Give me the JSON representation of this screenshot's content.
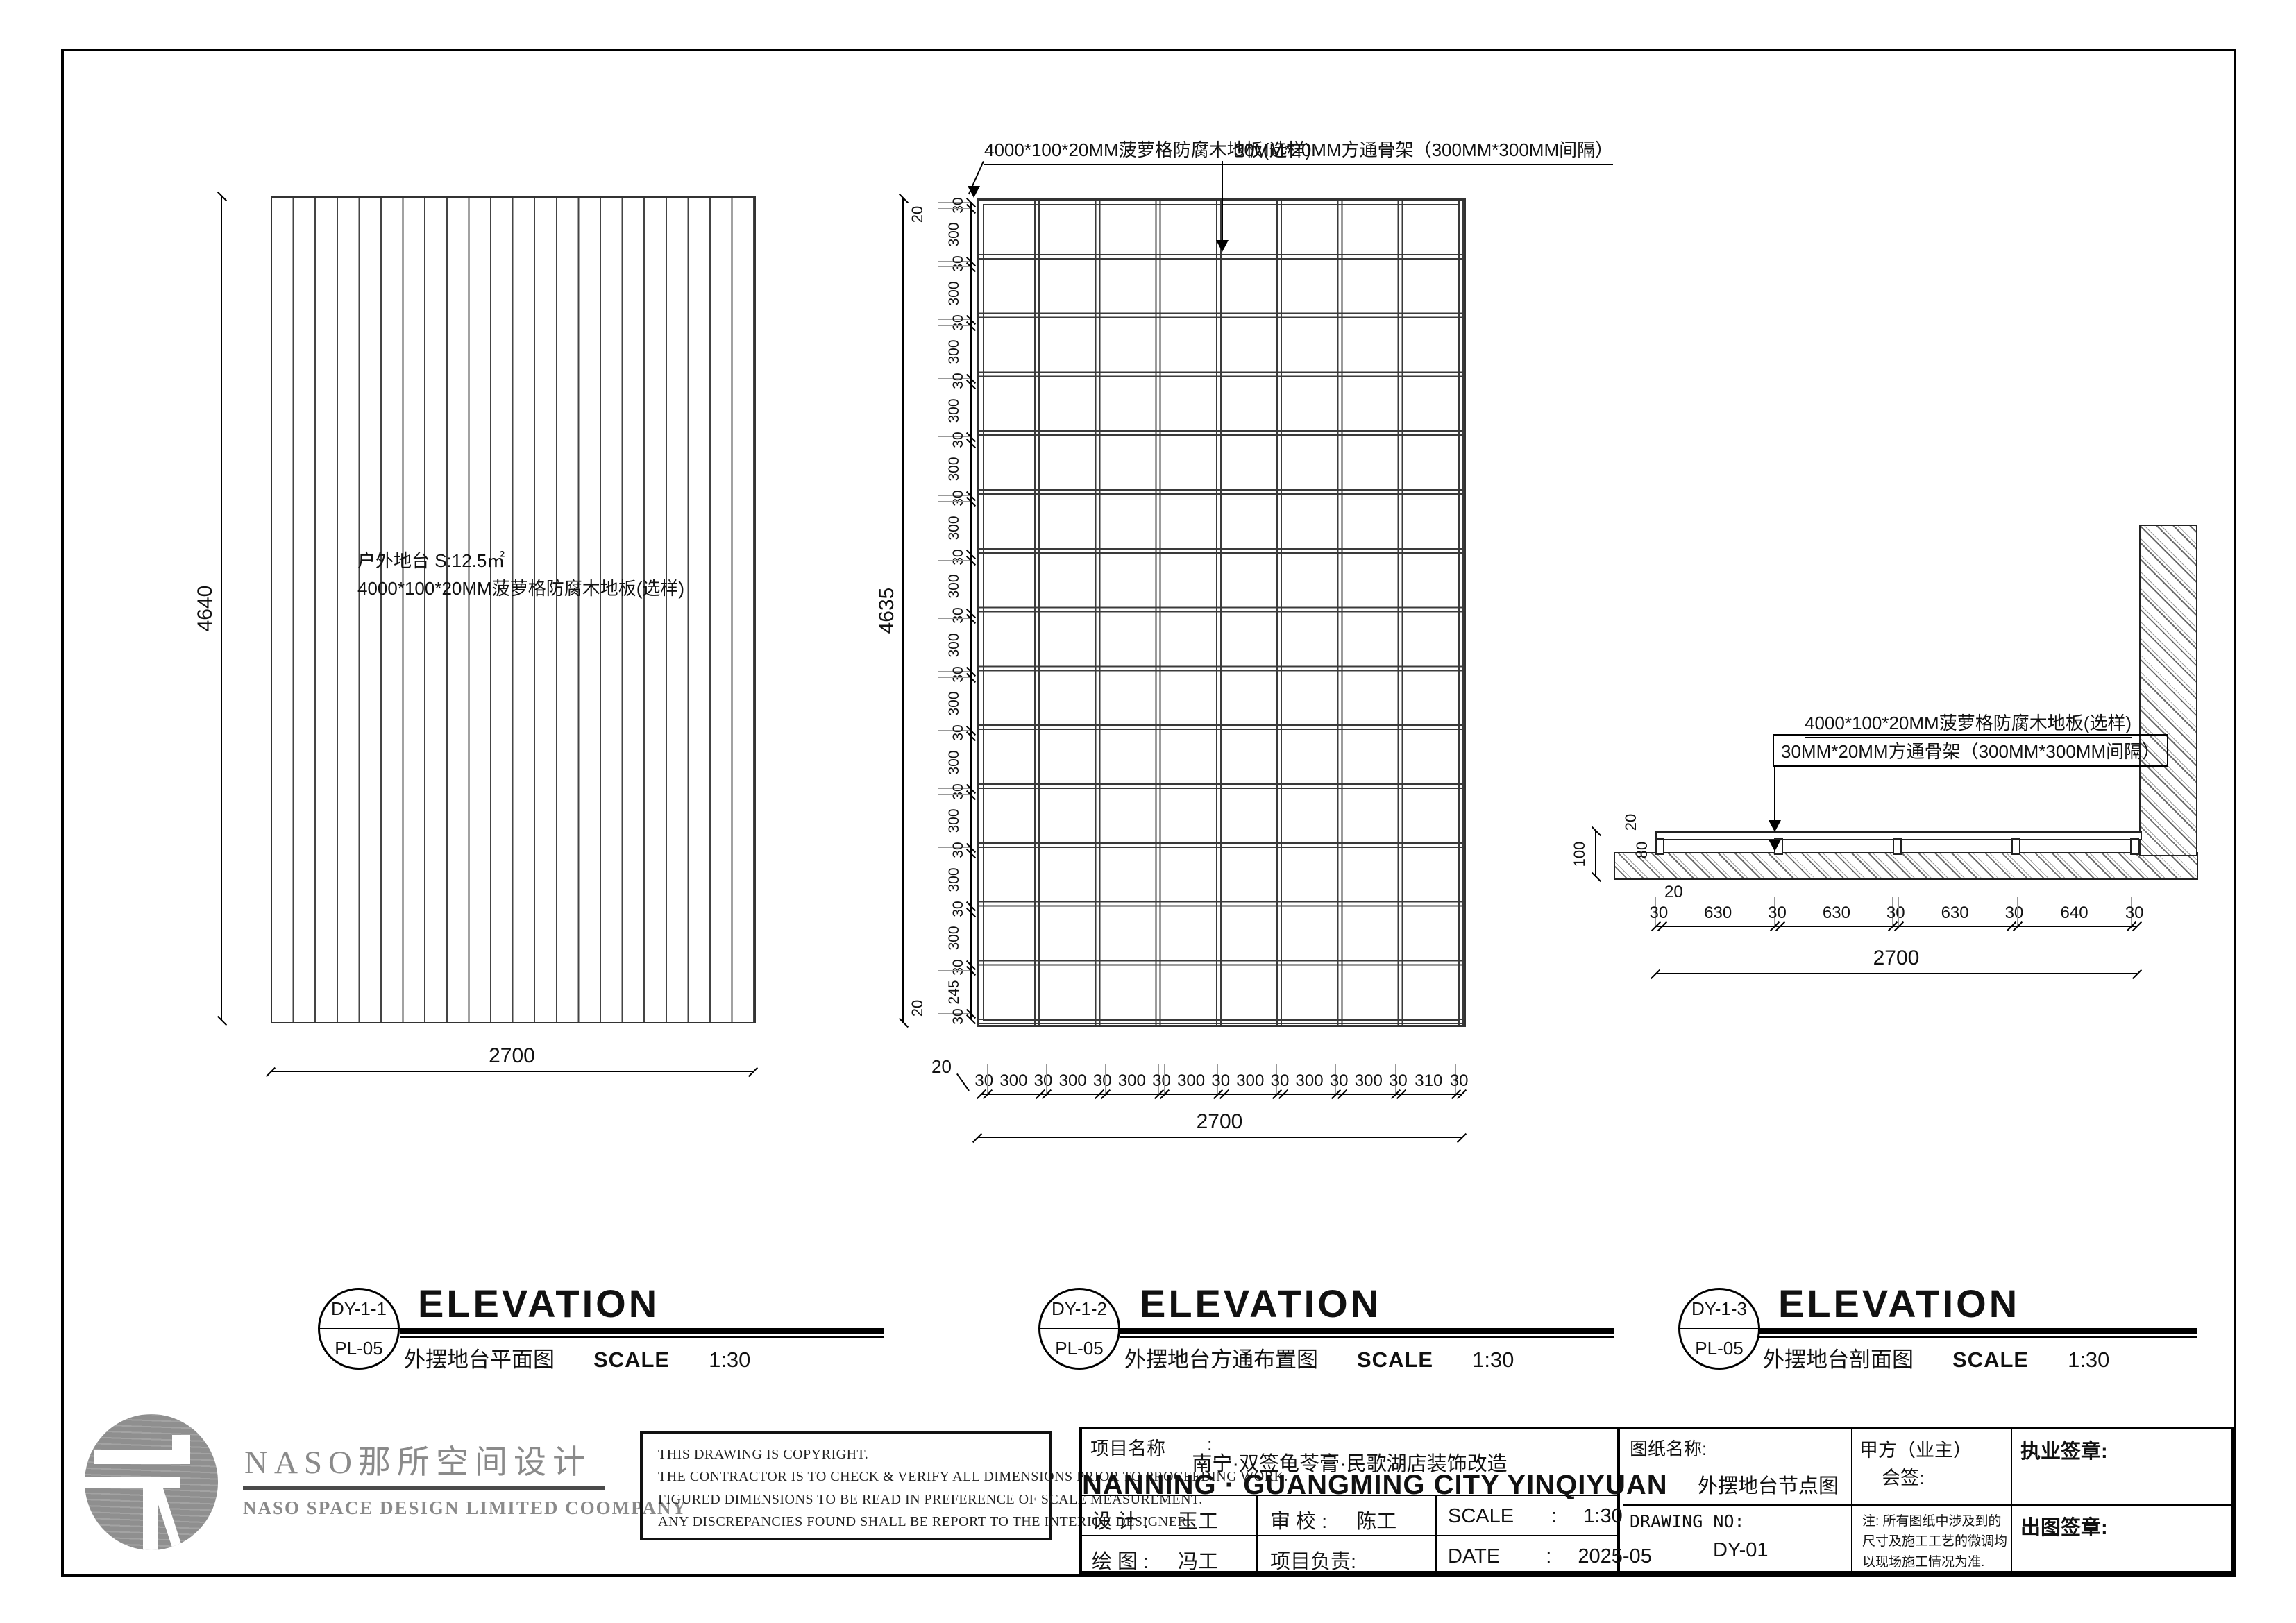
{
  "views": [
    {
      "ref": "DY-1-1",
      "sheet_no": "PL-05",
      "title": "ELEVATION",
      "name": "外摆地台平面图",
      "scale_label": "SCALE",
      "scale": "1:30",
      "area_note": "户外地台 S:12.5㎡",
      "material_note": "4000*100*20MM菠萝格防腐木地板(选样)",
      "dim_height": "4640",
      "dim_width": "2700"
    },
    {
      "ref": "DY-1-2",
      "sheet_no": "PL-05",
      "title": "ELEVATION",
      "name": "外摆地台方通布置图",
      "scale_label": "SCALE",
      "scale": "1:30",
      "callout_floor": "4000*100*20MM菠萝格防腐木地板(选样)",
      "callout_frame": "30MM*20MM方通骨架（300MM*300MM间隔）",
      "dim_height": "4635",
      "dim_width": "2700",
      "edge_top": "20",
      "edge_bottom": "20",
      "edge_left": "20",
      "left_chain": [
        "30",
        "300",
        "30",
        "300",
        "30",
        "300",
        "30",
        "300",
        "30",
        "300",
        "30",
        "300",
        "30",
        "300",
        "30",
        "300",
        "30",
        "300",
        "30",
        "300",
        "30",
        "300",
        "30",
        "300",
        "30",
        "300",
        "30",
        "245",
        "30"
      ],
      "bottom_chain": [
        "30",
        "300",
        "30",
        "300",
        "30",
        "300",
        "30",
        "300",
        "30",
        "300",
        "30",
        "300",
        "30",
        "300",
        "30",
        "310",
        "30"
      ]
    },
    {
      "ref": "DY-1-3",
      "sheet_no": "PL-05",
      "title": "ELEVATION",
      "name": "外摆地台剖面图",
      "scale_label": "SCALE",
      "scale": "1:30",
      "callout_floor": "4000*100*20MM菠萝格防腐木地板(选样)",
      "callout_frame": "30MM*20MM方通骨架（300MM*300MM间隔）",
      "dim_v_overall": "100",
      "dim_v_board": "20",
      "dim_v_frame": "80",
      "leader_bottom": "20",
      "bottom_chain": [
        "30",
        "630",
        "30",
        "630",
        "30",
        "630",
        "30",
        "640",
        "30"
      ],
      "dim_width": "2700"
    }
  ],
  "titleblock": {
    "logo_cn": "NASO那所空间设计",
    "logo_en": "NASO  SPACE  DESIGN  LIMITED  COOMPANY",
    "copyright_lines": [
      "THIS DRAWING IS COPYRIGHT.",
      "THE CONTRACTOR IS TO CHECK & VERIFY ALL DIMENSIONS PRIOR TO PROCEEDING WORK.",
      "FIGURED DIMENSIONS TO BE READ IN PREFERENCE OF SCALE MEASUREMENT.",
      "ANY DISCREPANCIES FOUND SHALL BE REPORT TO THE INTERIOR DESIGNER."
    ],
    "project_label": "项目名称",
    "project_colon": ":",
    "project_name_cn": "南宁·双签龟苓膏·民歌湖店装饰改造",
    "project_name_en": "NANNING · GUANGMING CITY YINQIYUAN",
    "design_label": "设  计 :",
    "design_value": "玉工",
    "check_label": "审  校 :",
    "check_value": "陈工",
    "scale_label": "SCALE",
    "scale_colon": ":",
    "scale_value": "1:30",
    "draw_label": "绘  图 :",
    "draw_value": "冯工",
    "lead_label": "项目负责:",
    "date_label": "DATE",
    "date_colon": ":",
    "date_value": "2025-05",
    "sheet_title_label": "图纸名称:",
    "sheet_title_value": "外摆地台节点图",
    "client_label": "甲方（业主）",
    "client_label2": "会签:",
    "license_seal_label": "执业签章:",
    "drawing_no_label": "DRAWING NO:",
    "drawing_no_value": "DY-01",
    "note_lines": [
      "注: 所有图纸中涉及到的",
      "尺寸及施工工艺的微调均",
      "以现场施工情况为准."
    ],
    "issue_seal_label": "出图签章:"
  }
}
